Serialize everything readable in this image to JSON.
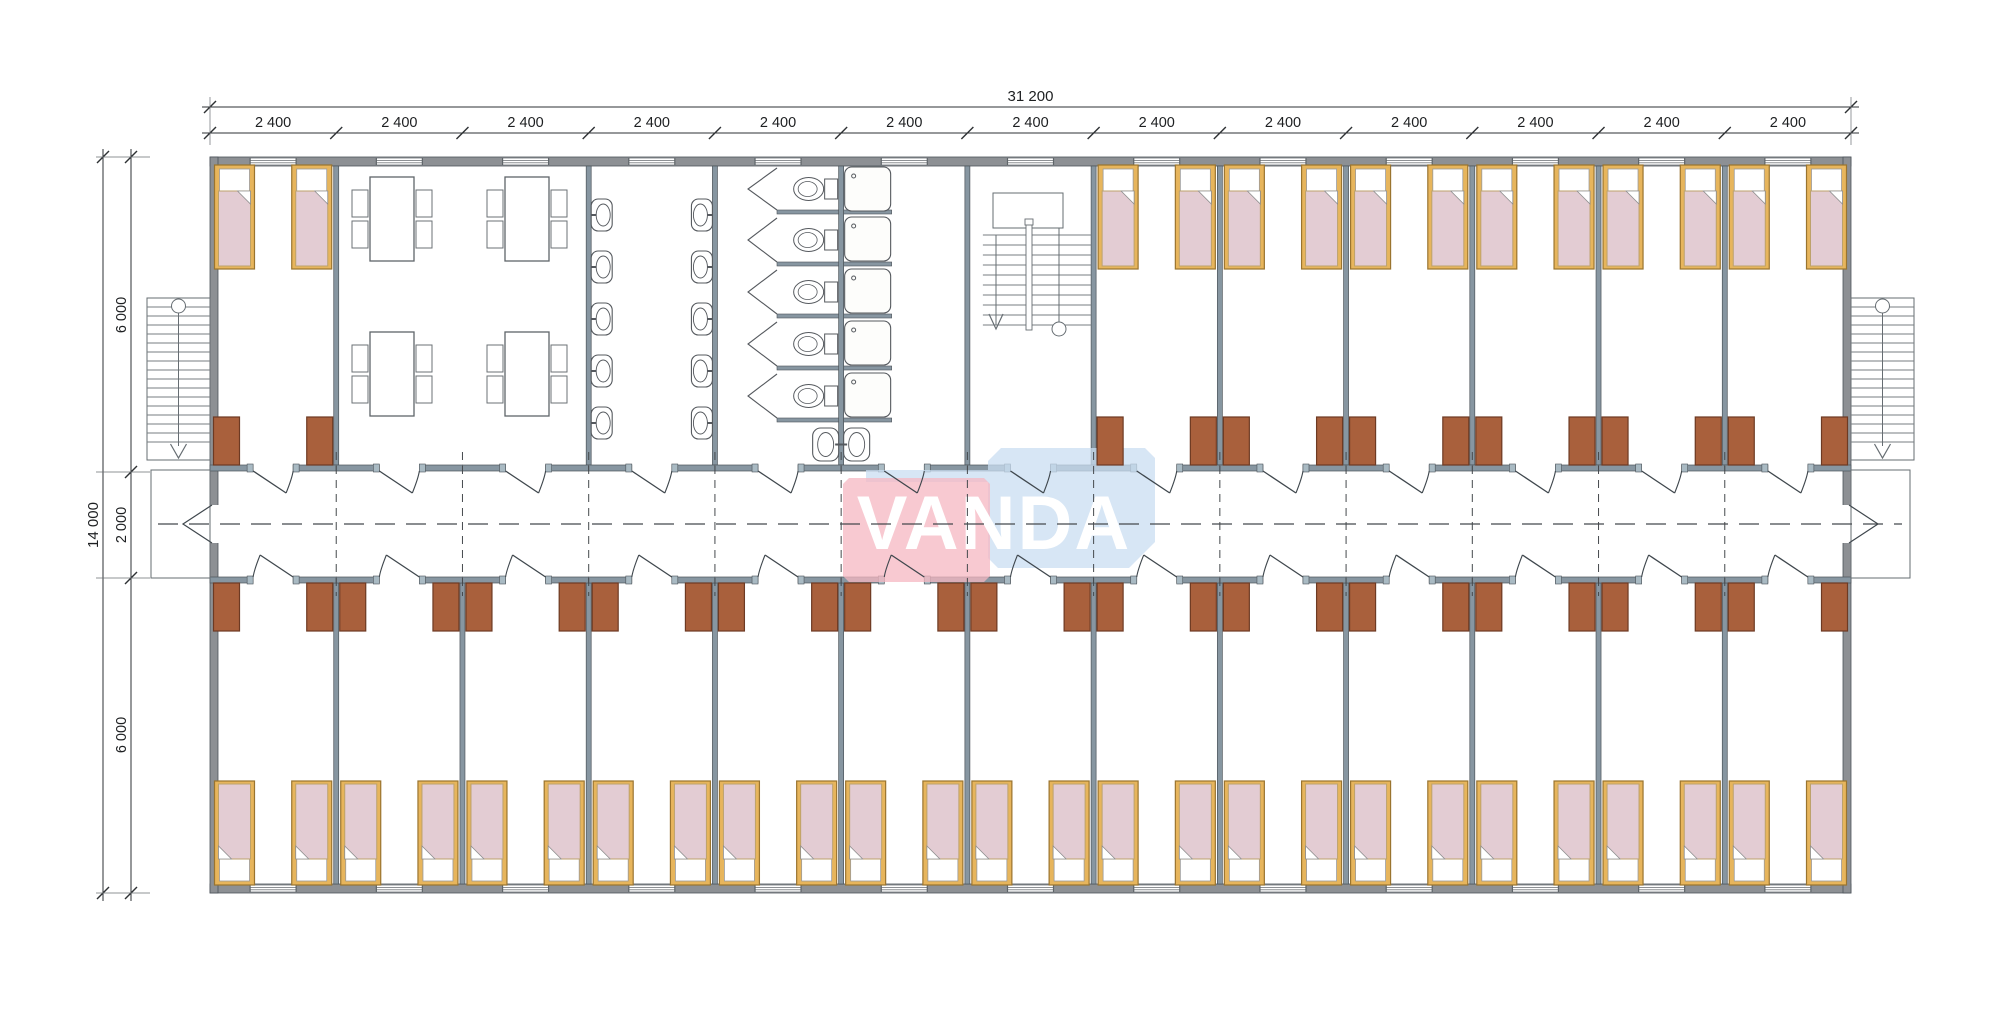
{
  "watermark": {
    "text": "VANDA",
    "pink_color": "#f5b7c1",
    "blue_color": "#c9def1",
    "text_color": "#ffffff",
    "opacity": 0.75
  },
  "dimensions": {
    "horizontal_total": "31 200",
    "horizontal_segments": [
      "2 400",
      "2 400",
      "2 400",
      "2 400",
      "2 400",
      "2 400",
      "2 400",
      "2 400",
      "2 400",
      "2 400",
      "2 400",
      "2 400",
      "2 400"
    ],
    "vertical_total": "14 000",
    "vertical_segments": [
      "6 000",
      "2 000",
      "6 000"
    ]
  },
  "colors": {
    "paper": "#ffffff",
    "wall_exterior": "#8d9094",
    "wall_interior": "#8796a1",
    "wall_outline": "#4d545a",
    "wall_cap": "#a9bac3",
    "cabinet": "#a9603c",
    "cabinet_border": "#6d3a23",
    "bed_frame": "#e7b55c",
    "bed_frame_border": "#9a742f",
    "mattress": "#e3ccd3",
    "mattress_border": "#bda26b",
    "pillow": "#ffffff",
    "fixture_line": "#55595e",
    "door_line": "#3f474d",
    "dash_line": "#45494d",
    "dim_line": "#2e3134",
    "dim_text": "#1d1f21"
  },
  "rooms": {
    "top_row": [
      {
        "type": "bedroom",
        "beds": 2,
        "cabinets": 2
      },
      {
        "type": "dining-room",
        "tables": 4,
        "chairs": 16
      },
      {
        "type": "washroom",
        "sinks": 10
      },
      {
        "type": "toilet-room",
        "stalls": 5,
        "toilets": 5
      },
      {
        "type": "shower-room",
        "showers": 5,
        "sinks": 2
      },
      {
        "type": "stairwell",
        "stairs": 1
      },
      {
        "type": "bedroom",
        "beds": 2,
        "cabinets": 2
      },
      {
        "type": "bedroom",
        "beds": 2,
        "cabinets": 2
      },
      {
        "type": "bedroom",
        "beds": 2,
        "cabinets": 2
      },
      {
        "type": "bedroom",
        "beds": 2,
        "cabinets": 2
      },
      {
        "type": "bedroom",
        "beds": 2,
        "cabinets": 2
      },
      {
        "type": "bedroom",
        "beds": 2,
        "cabinets": 2
      }
    ],
    "bottom_row_bedrooms": 13,
    "beds_total": 40,
    "exterior_stairs": 2
  },
  "layout": {
    "canvas": {
      "w": 2000,
      "h": 1032
    },
    "building": {
      "x0": 210,
      "y0": 157,
      "x1": 1851,
      "y1": 893,
      "ext_wall": 9,
      "int_wall": 5
    },
    "bays": 13,
    "top_bedroom_bays": [
      0,
      7,
      8,
      9,
      10,
      11,
      12
    ],
    "dining_bays": [
      1,
      2
    ],
    "wash_bay": 3,
    "toilet_bay": 4,
    "shower_bay": 5,
    "stair_bay": 6,
    "corridor": {
      "wall_top_y": 465,
      "wall_bot_y": 577,
      "wall_t": 6,
      "center_y": 524,
      "door_w": 40
    },
    "window_w": 46,
    "bed": {
      "w": 40,
      "h": 104,
      "top_y": 165,
      "bot_y": 781
    },
    "cabinet": {
      "w": 26,
      "h": 48,
      "top_y": 417,
      "bot_y": 583
    },
    "tables": [
      [
        370,
        177
      ],
      [
        505,
        177
      ],
      [
        370,
        332
      ],
      [
        505,
        332
      ]
    ],
    "table_size": [
      44,
      84
    ],
    "sink_cys": [
      215,
      267,
      319,
      371,
      423
    ],
    "stall_tops": [
      166,
      216,
      268,
      320,
      372
    ],
    "stall_parts": [
      212,
      264,
      316,
      368,
      420
    ],
    "int_stair": {
      "landing": [
        993,
        193,
        70,
        35
      ],
      "tread_y0": 235,
      "treads": 10,
      "step": 10,
      "div_x": 1026,
      "left_stem_x": 996,
      "right_stem_x": 1059,
      "circle_y": 329
    },
    "ext_stair": {
      "shaft_y": 298,
      "shaft_h": 162,
      "shaft_w": 63,
      "treads": 16,
      "landing_y": 470,
      "landing_h": 108,
      "landing_w": 59
    },
    "dims": {
      "line1_y": 107,
      "line2_y": 133,
      "vline1_x": 103,
      "vline2_x": 131,
      "v_ticks": [
        157,
        472,
        578,
        893
      ],
      "v_label_cys": [
        315,
        525,
        735
      ],
      "h_label_y": 127,
      "total_label_y": 101,
      "v_total_cy": 525
    },
    "watermark": {
      "pink": [
        843,
        478,
        147,
        104
      ],
      "blue": [
        988,
        448,
        167,
        120
      ],
      "chamfer": 13,
      "strip": [
        866,
        470,
        122,
        12
      ],
      "text_x": 994,
      "text_y": 549,
      "font_size": 76
    }
  }
}
